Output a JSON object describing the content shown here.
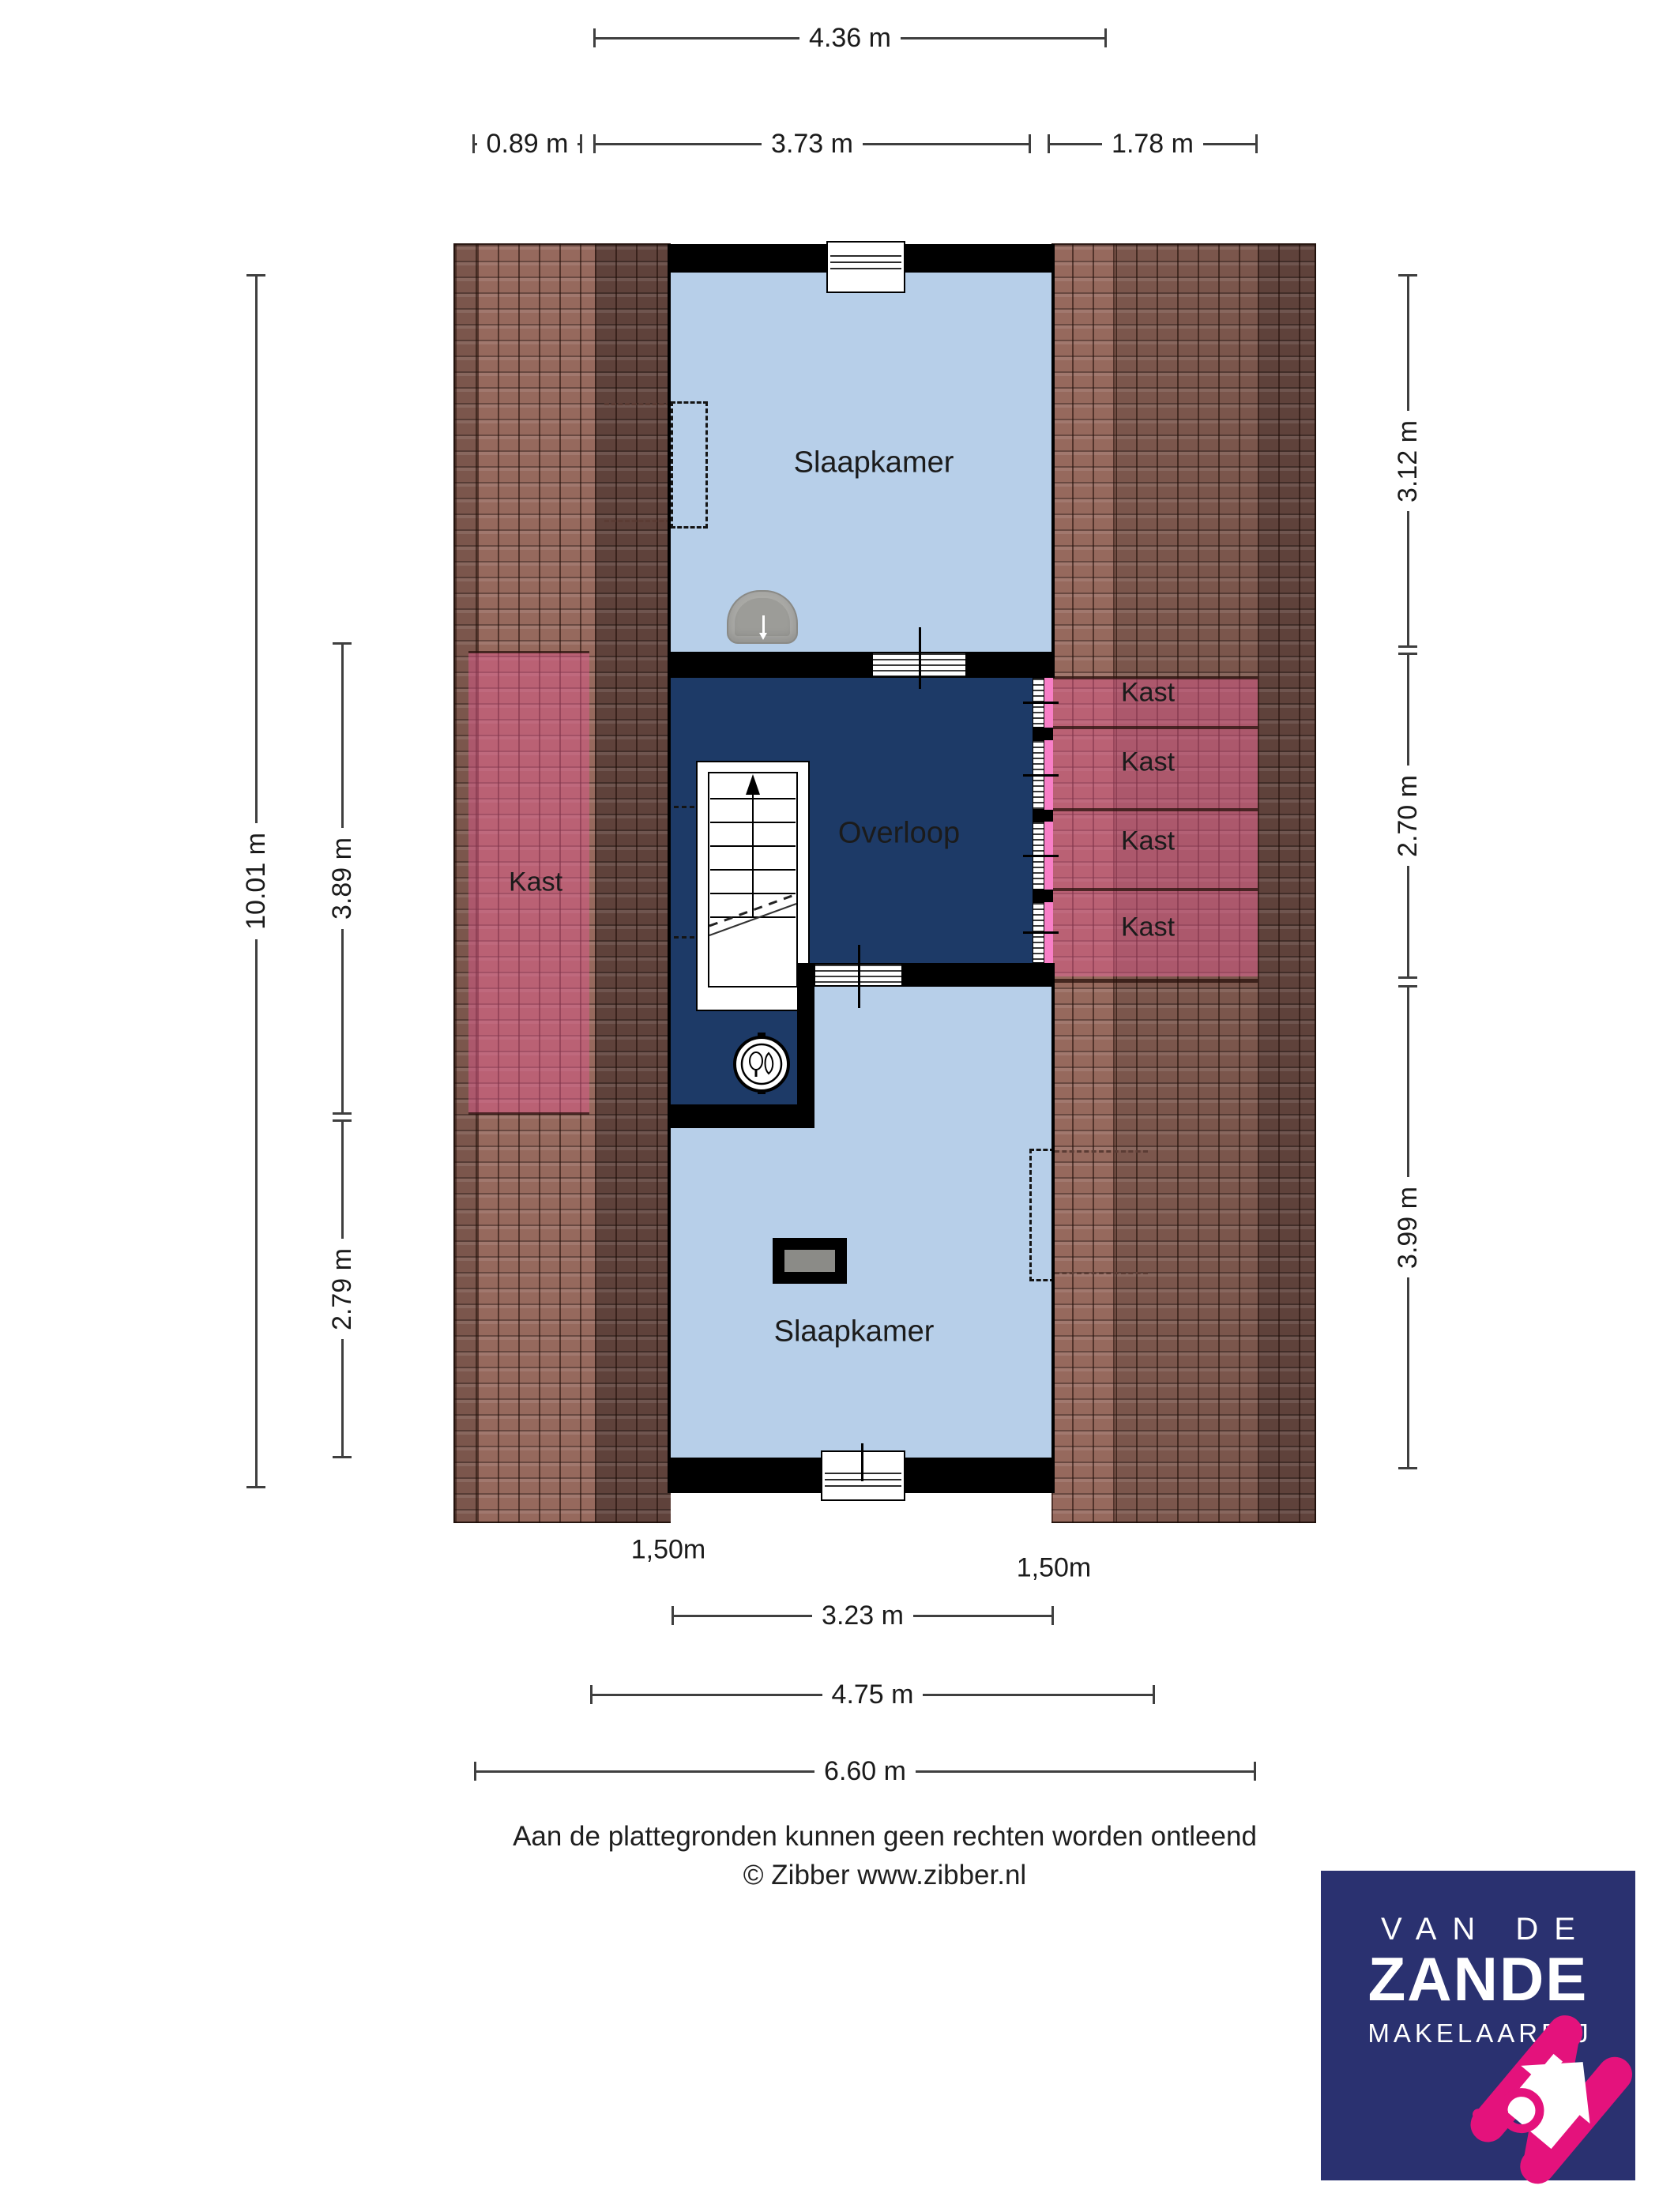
{
  "plan": {
    "labels": {
      "bedroom_top": "Slaapkamer",
      "bedroom_bottom": "Slaapkamer",
      "landing": "Overloop",
      "closet_left": "Kast",
      "closet_r1": "Kast",
      "closet_r2": "Kast",
      "closet_r3": "Kast",
      "closet_r4": "Kast"
    },
    "colors": {
      "room": "#b7cfe9",
      "hall": "#1d3a67",
      "wall": "#000000",
      "roof_mid": "#7b564c",
      "roof_light": "#96695d",
      "roof_dark": "#5f423b",
      "closet_wash": "rgba(222,90,140,0.5)",
      "door_pink": "#f87fc7"
    }
  },
  "dimensions": {
    "top": [
      {
        "label": "4.36 m"
      },
      {
        "label": "0.89 m"
      },
      {
        "label": "3.73 m"
      },
      {
        "label": "1.78 m"
      }
    ],
    "bottom": [
      {
        "label": "1,50m"
      },
      {
        "label": "1,50m"
      },
      {
        "label": "3.23 m"
      },
      {
        "label": "4.75 m"
      },
      {
        "label": "6.60 m"
      }
    ],
    "left": [
      {
        "label": "10.01 m"
      },
      {
        "label": "3.89 m"
      },
      {
        "label": "2.79 m"
      }
    ],
    "right": [
      {
        "label": "3.12 m"
      },
      {
        "label": "2.70 m"
      },
      {
        "label": "3.99 m"
      }
    ]
  },
  "footer": {
    "line1": "Aan de plattegronden kunnen geen rechten worden ontleend",
    "line2": "© Zibber www.zibber.nl"
  },
  "logo": {
    "line1": "VAN DE",
    "line2": "ZANDE",
    "line3": "MAKELAARDIJ",
    "bg": "#2a3170",
    "accent": "#e4127c"
  }
}
